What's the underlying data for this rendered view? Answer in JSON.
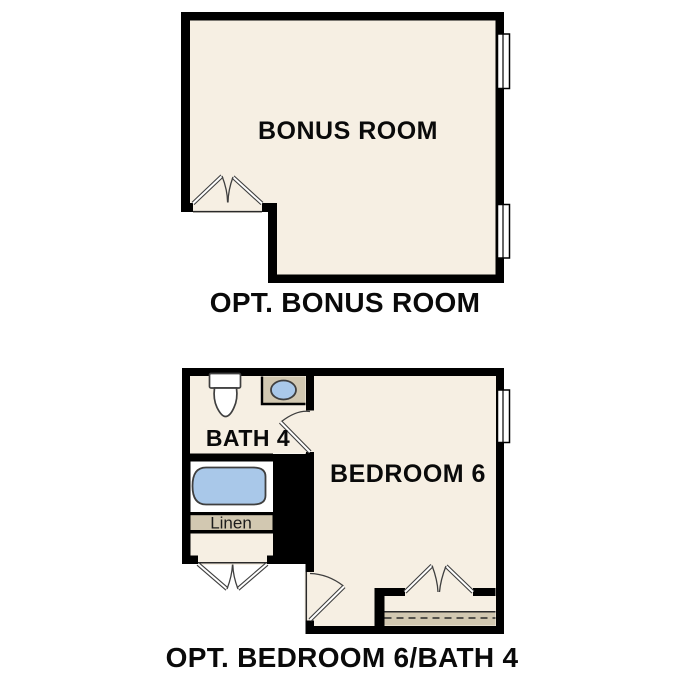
{
  "colors": {
    "floor": "#f6efe3",
    "tan": "#d2c8b1",
    "blue": "#a9c8e9",
    "wall": "#000000",
    "outline": "#3f3f3f",
    "text": "#0a0a0a",
    "bg": "#ffffff"
  },
  "plans": {
    "bonus": {
      "room_label": "BONUS ROOM",
      "caption": "OPT. BONUS ROOM"
    },
    "bedroom": {
      "room_label": "BEDROOM 6",
      "bath_label": "BATH 4",
      "linen_label": "Linen",
      "caption": "OPT. BEDROOM 6/BATH 4"
    }
  }
}
